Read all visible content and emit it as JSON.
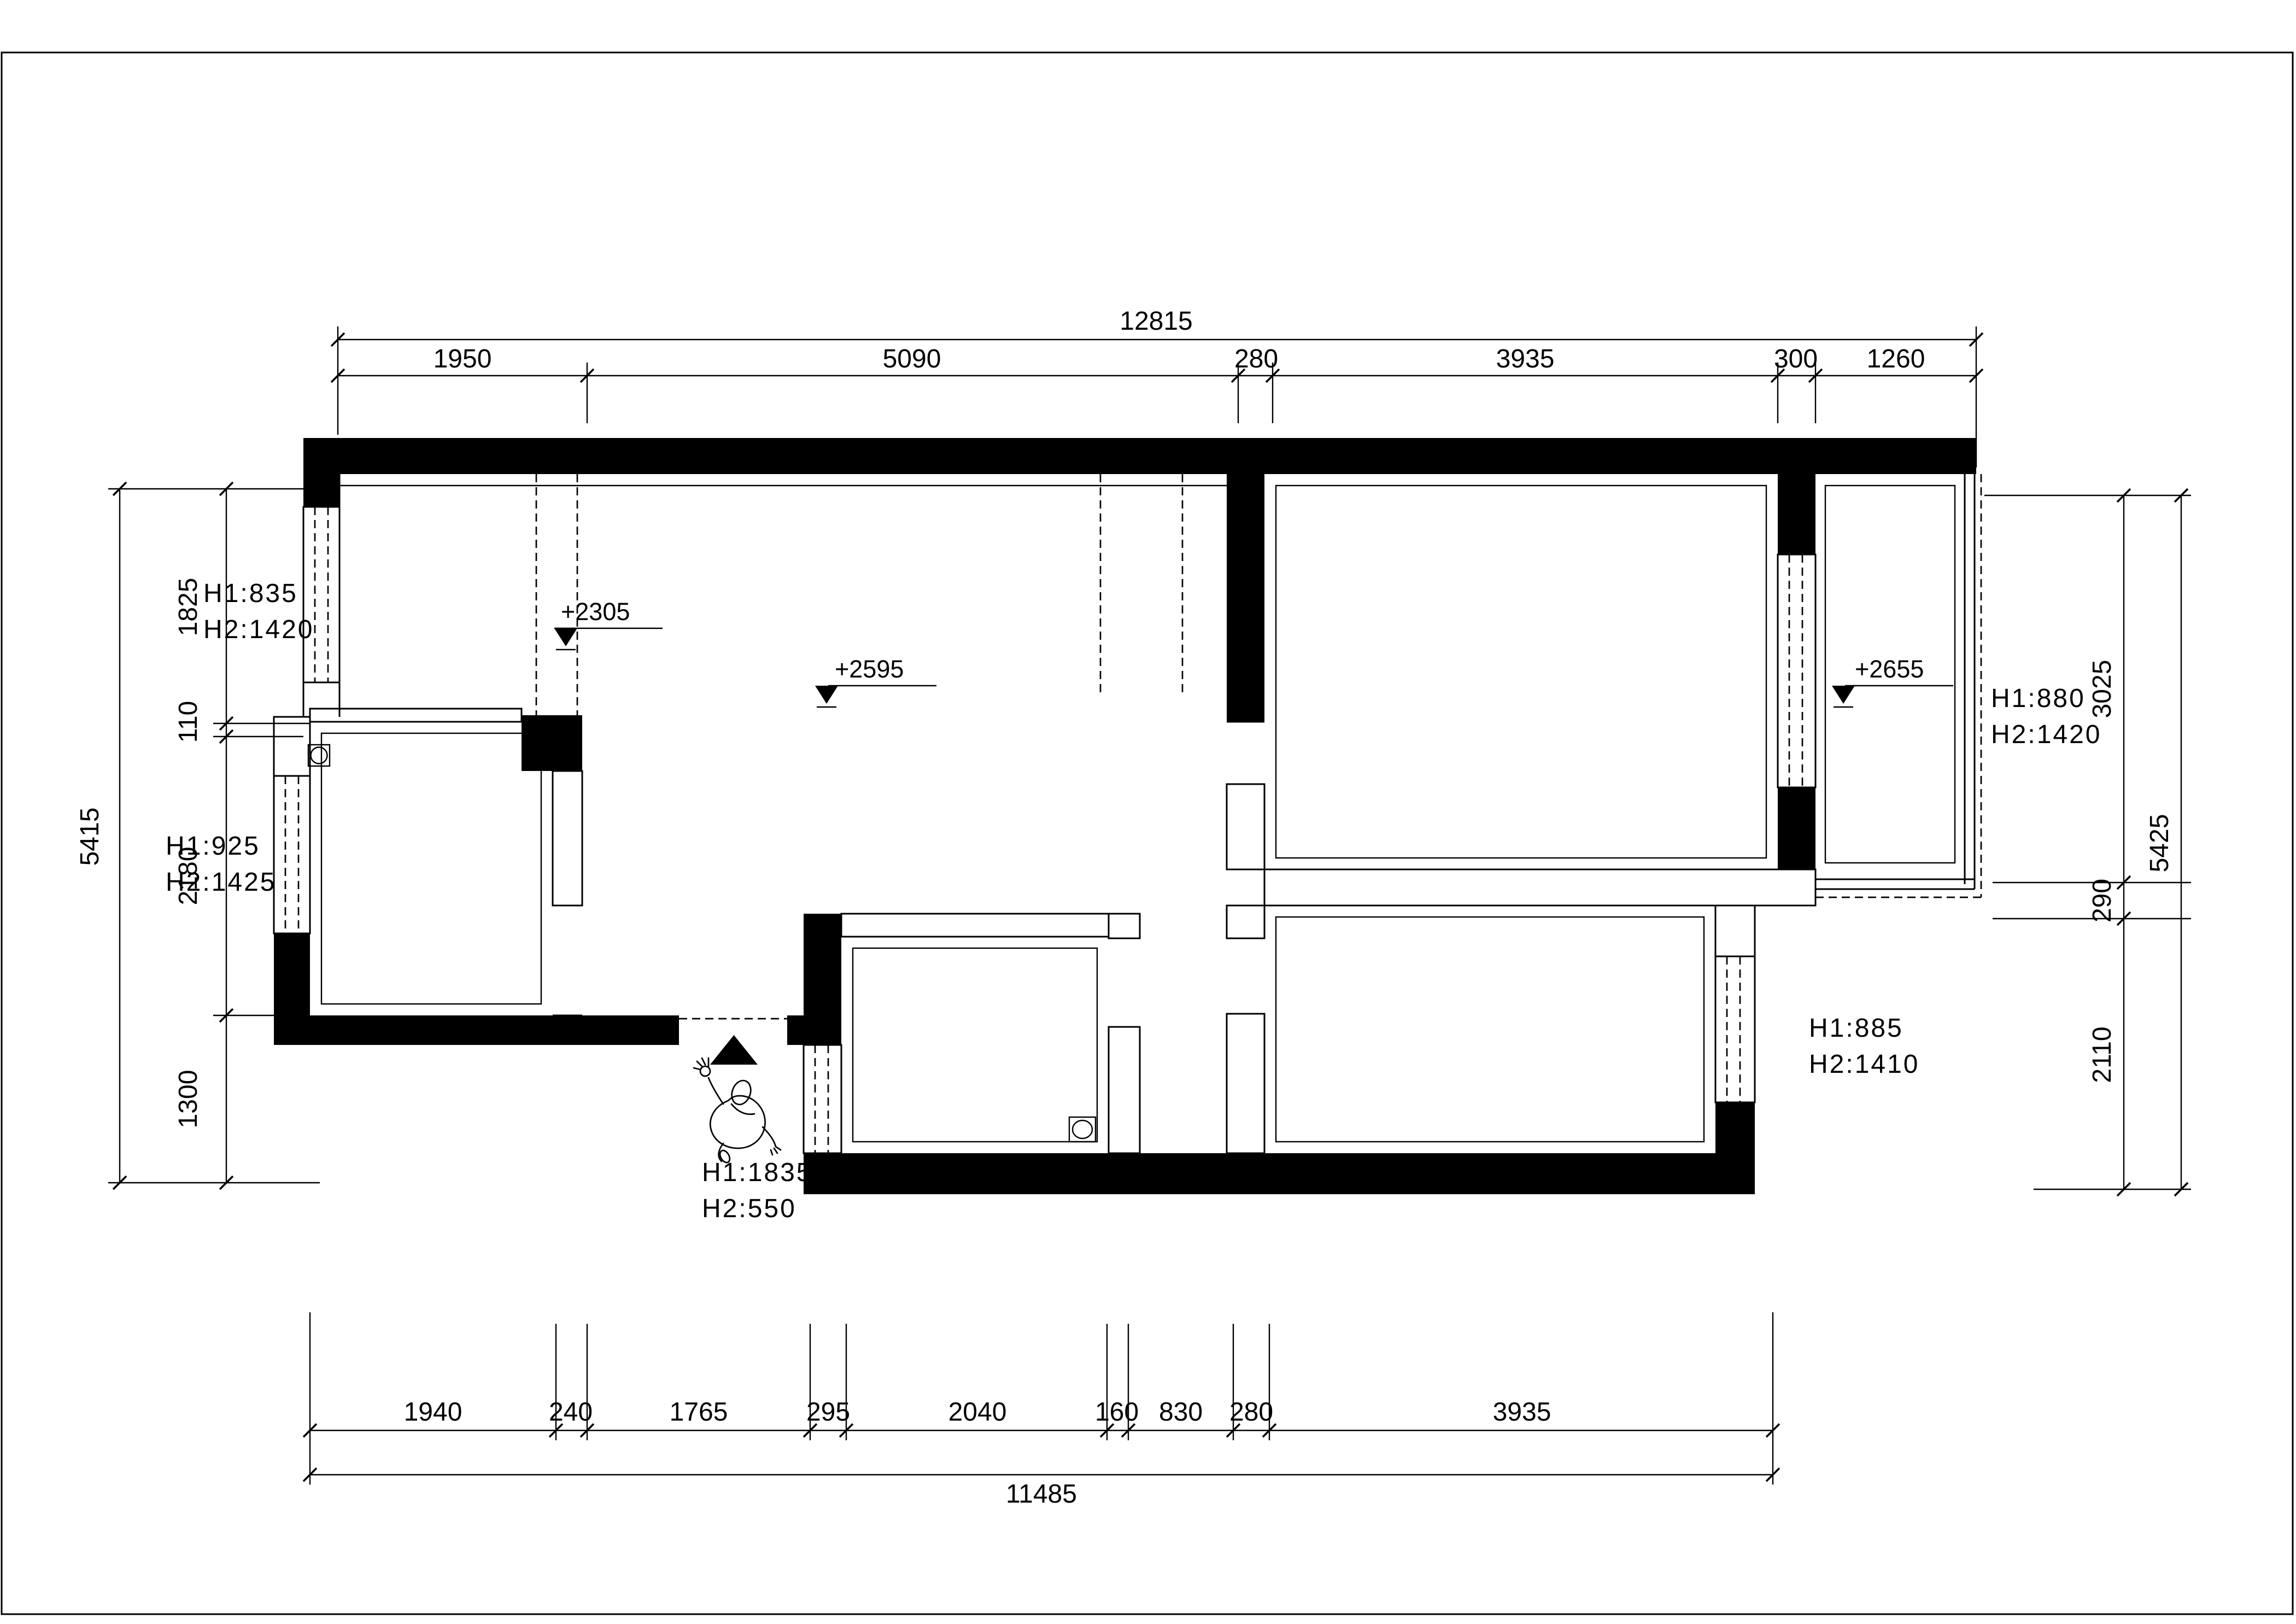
{
  "drawing": {
    "type": "floor-plan-survey",
    "background": "#ffffff",
    "line_color": "#000000"
  },
  "dimensions": {
    "top": {
      "total": "12815",
      "segments": [
        "1950",
        "5090",
        "280",
        "3935",
        "300",
        "1260"
      ]
    },
    "bottom": {
      "total": "11485",
      "segments": [
        "1940",
        "240",
        "1765",
        "295",
        "2040",
        "160",
        "830",
        "280",
        "3935"
      ]
    },
    "left": {
      "total": "5415",
      "segments": [
        "1825",
        "110",
        "2180",
        "1300"
      ]
    },
    "right": {
      "total": "5425",
      "segments": [
        "3025",
        "290",
        "2110"
      ]
    }
  },
  "levels": {
    "living_beam": "+2305",
    "living": "+2595",
    "balcony": "+2655"
  },
  "openings": {
    "win_left_upper": {
      "l1": "H1:835",
      "l2": "H2:1420"
    },
    "win_left_lower": {
      "l1": "H1:925",
      "l2": "H2:1425"
    },
    "win_right_upper": {
      "l1": "H1:880",
      "l2": "H2:1420"
    },
    "win_right_lower": {
      "l1": "H1:885",
      "l2": "H2:1410"
    },
    "entry_door": {
      "l1": "H1:1835",
      "l2": "H2:550"
    }
  }
}
